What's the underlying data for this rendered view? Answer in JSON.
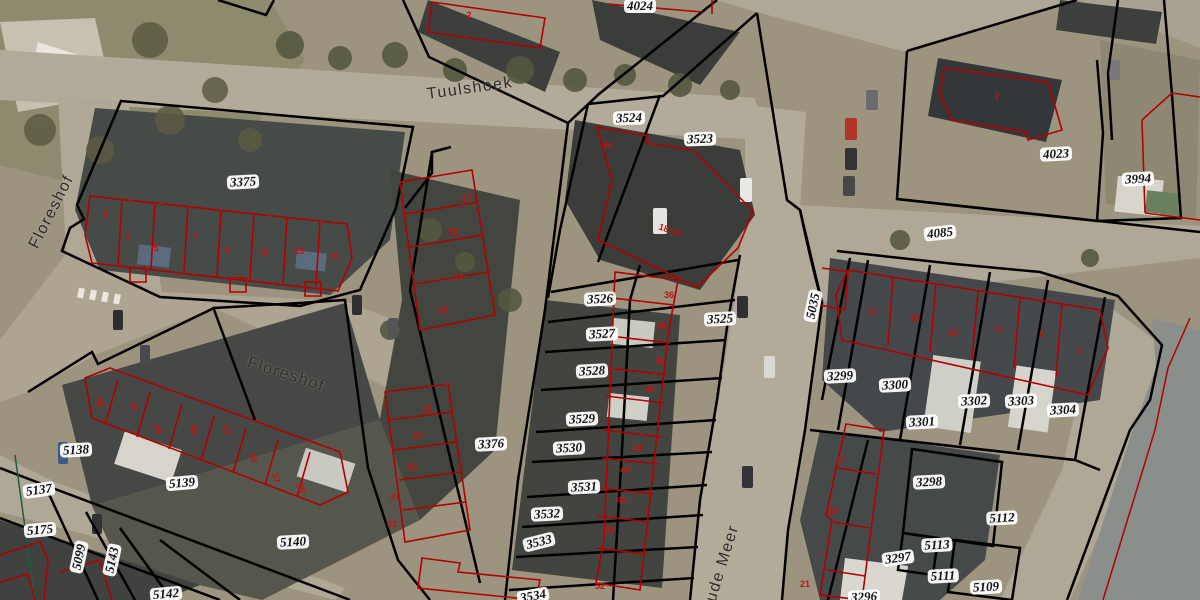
{
  "map": {
    "description": "Aerial cadastral map view with parcel boundaries and building outlines",
    "colors": {
      "parcel_boundary": "#000000",
      "building_outline": "#b40000",
      "house_number_text": "#c41111",
      "parcel_label_bg": "#ffffff",
      "parcel_label_text": "#111111",
      "street_label_text": "#2d2d2d",
      "ground": "#9c947f",
      "road": "#b3ab99",
      "roof_dark": "#3f423f",
      "vegetation": "#55583f",
      "water": "#8b8f8c"
    },
    "street_labels": [
      {
        "text": "Tuulshoek",
        "x": 470,
        "y": 89,
        "rot": -8
      },
      {
        "text": "Floreshof",
        "x": 52,
        "y": 212,
        "rot": -63
      },
      {
        "text": "Floreshof",
        "x": 286,
        "y": 375,
        "rot": 18
      },
      {
        "text": "Oude Meer",
        "x": 721,
        "y": 570,
        "rot": -73
      }
    ],
    "parcel_labels": [
      {
        "text": "4024",
        "x": 640,
        "y": 6,
        "rot": 0
      },
      {
        "text": "3524",
        "x": 629,
        "y": 118,
        "rot": -2
      },
      {
        "text": "3523",
        "x": 700,
        "y": 139,
        "rot": -2
      },
      {
        "text": "3375",
        "x": 243,
        "y": 182,
        "rot": -3
      },
      {
        "text": "4023",
        "x": 1056,
        "y": 154,
        "rot": -3
      },
      {
        "text": "3994",
        "x": 1138,
        "y": 179,
        "rot": -3
      },
      {
        "text": "4085",
        "x": 940,
        "y": 233,
        "rot": -6
      },
      {
        "text": "5035",
        "x": 813,
        "y": 306,
        "rot": -78
      },
      {
        "text": "3526",
        "x": 600,
        "y": 299,
        "rot": -3
      },
      {
        "text": "3525",
        "x": 720,
        "y": 319,
        "rot": -3
      },
      {
        "text": "3527",
        "x": 602,
        "y": 334,
        "rot": -3
      },
      {
        "text": "3528",
        "x": 592,
        "y": 371,
        "rot": -3
      },
      {
        "text": "3529",
        "x": 582,
        "y": 419,
        "rot": -3
      },
      {
        "text": "3530",
        "x": 569,
        "y": 448,
        "rot": -3
      },
      {
        "text": "3531",
        "x": 584,
        "y": 487,
        "rot": -3
      },
      {
        "text": "3532",
        "x": 547,
        "y": 514,
        "rot": -3
      },
      {
        "text": "3533",
        "x": 539,
        "y": 542,
        "rot": -14
      },
      {
        "text": "3534",
        "x": 533,
        "y": 596,
        "rot": -10
      },
      {
        "text": "3376",
        "x": 491,
        "y": 444,
        "rot": -3
      },
      {
        "text": "5138",
        "x": 76,
        "y": 450,
        "rot": -3
      },
      {
        "text": "5137",
        "x": 39,
        "y": 490,
        "rot": -8
      },
      {
        "text": "5175",
        "x": 40,
        "y": 530,
        "rot": -5
      },
      {
        "text": "5139",
        "x": 182,
        "y": 483,
        "rot": -5
      },
      {
        "text": "5099",
        "x": 79,
        "y": 557,
        "rot": -78
      },
      {
        "text": "5143",
        "x": 112,
        "y": 560,
        "rot": -78
      },
      {
        "text": "5140",
        "x": 293,
        "y": 542,
        "rot": -3
      },
      {
        "text": "5142",
        "x": 166,
        "y": 594,
        "rot": -5
      },
      {
        "text": "3299",
        "x": 840,
        "y": 376,
        "rot": -3
      },
      {
        "text": "3300",
        "x": 895,
        "y": 385,
        "rot": -3
      },
      {
        "text": "3301",
        "x": 922,
        "y": 422,
        "rot": -3
      },
      {
        "text": "3302",
        "x": 974,
        "y": 401,
        "rot": -3
      },
      {
        "text": "3303",
        "x": 1021,
        "y": 401,
        "rot": -3
      },
      {
        "text": "3304",
        "x": 1063,
        "y": 410,
        "rot": -3
      },
      {
        "text": "3298",
        "x": 929,
        "y": 482,
        "rot": -3
      },
      {
        "text": "5112",
        "x": 1002,
        "y": 518,
        "rot": -3
      },
      {
        "text": "5113",
        "x": 937,
        "y": 545,
        "rot": -3
      },
      {
        "text": "3297",
        "x": 898,
        "y": 558,
        "rot": -8
      },
      {
        "text": "5111",
        "x": 943,
        "y": 576,
        "rot": -3
      },
      {
        "text": "5109",
        "x": 986,
        "y": 587,
        "rot": -3
      },
      {
        "text": "3296",
        "x": 864,
        "y": 597,
        "rot": -3
      }
    ],
    "house_numbers": [
      {
        "text": "2",
        "x": 469,
        "y": 15,
        "rot": 0
      },
      {
        "text": "7",
        "x": 997,
        "y": 97,
        "rot": 0
      },
      {
        "text": "1",
        "x": 106,
        "y": 214,
        "rot": 0
      },
      {
        "text": "3",
        "x": 128,
        "y": 236,
        "rot": 0
      },
      {
        "text": "5",
        "x": 156,
        "y": 248,
        "rot": 0
      },
      {
        "text": "7",
        "x": 196,
        "y": 237,
        "rot": 0
      },
      {
        "text": "9",
        "x": 228,
        "y": 250,
        "rot": 0
      },
      {
        "text": "11",
        "x": 264,
        "y": 252,
        "rot": 0
      },
      {
        "text": "13",
        "x": 299,
        "y": 251,
        "rot": 0
      },
      {
        "text": "15",
        "x": 334,
        "y": 256,
        "rot": 0
      },
      {
        "text": "17",
        "x": 467,
        "y": 198,
        "rot": 0
      },
      {
        "text": "19",
        "x": 453,
        "y": 232,
        "rot": 0
      },
      {
        "text": "21",
        "x": 459,
        "y": 277,
        "rot": 0
      },
      {
        "text": "23",
        "x": 443,
        "y": 310,
        "rot": 0
      },
      {
        "text": "25",
        "x": 427,
        "y": 409,
        "rot": 0
      },
      {
        "text": "27",
        "x": 418,
        "y": 436,
        "rot": 0
      },
      {
        "text": "29",
        "x": 412,
        "y": 467,
        "rot": 0
      },
      {
        "text": "31",
        "x": 395,
        "y": 497,
        "rot": 0
      },
      {
        "text": "33",
        "x": 392,
        "y": 524,
        "rot": 0
      },
      {
        "text": "49",
        "x": 100,
        "y": 402,
        "rot": 75
      },
      {
        "text": "47",
        "x": 134,
        "y": 407,
        "rot": 75
      },
      {
        "text": "45",
        "x": 157,
        "y": 429,
        "rot": 75
      },
      {
        "text": "43",
        "x": 194,
        "y": 429,
        "rot": 75
      },
      {
        "text": "41",
        "x": 227,
        "y": 430,
        "rot": 75
      },
      {
        "text": "39",
        "x": 253,
        "y": 458,
        "rot": 75
      },
      {
        "text": "37",
        "x": 276,
        "y": 478,
        "rot": 75
      },
      {
        "text": "35",
        "x": 301,
        "y": 488,
        "rot": 75
      },
      {
        "text": "35",
        "x": 608,
        "y": 145,
        "rot": 10
      },
      {
        "text": "18-34",
        "x": 670,
        "y": 230,
        "rot": 18
      },
      {
        "text": "36",
        "x": 669,
        "y": 295,
        "rot": 0
      },
      {
        "text": "38",
        "x": 661,
        "y": 326,
        "rot": 0
      },
      {
        "text": "40",
        "x": 660,
        "y": 361,
        "rot": 0
      },
      {
        "text": "42",
        "x": 650,
        "y": 389,
        "rot": 0
      },
      {
        "text": "44",
        "x": 637,
        "y": 448,
        "rot": 0
      },
      {
        "text": "46",
        "x": 625,
        "y": 470,
        "rot": 0
      },
      {
        "text": "48",
        "x": 622,
        "y": 500,
        "rot": 0
      },
      {
        "text": "50",
        "x": 609,
        "y": 530,
        "rot": 0
      },
      {
        "text": "52",
        "x": 600,
        "y": 586,
        "rot": 0
      },
      {
        "text": "17",
        "x": 872,
        "y": 312,
        "rot": 0
      },
      {
        "text": "15",
        "x": 915,
        "y": 318,
        "rot": 0
      },
      {
        "text": "13",
        "x": 953,
        "y": 333,
        "rot": 0
      },
      {
        "text": "11",
        "x": 999,
        "y": 329,
        "rot": 0
      },
      {
        "text": "9",
        "x": 1042,
        "y": 334,
        "rot": 0
      },
      {
        "text": "7",
        "x": 1079,
        "y": 351,
        "rot": 0
      },
      {
        "text": "17",
        "x": 841,
        "y": 460,
        "rot": 0
      },
      {
        "text": "19",
        "x": 833,
        "y": 511,
        "rot": 0
      },
      {
        "text": "21",
        "x": 805,
        "y": 584,
        "rot": 0
      }
    ]
  }
}
